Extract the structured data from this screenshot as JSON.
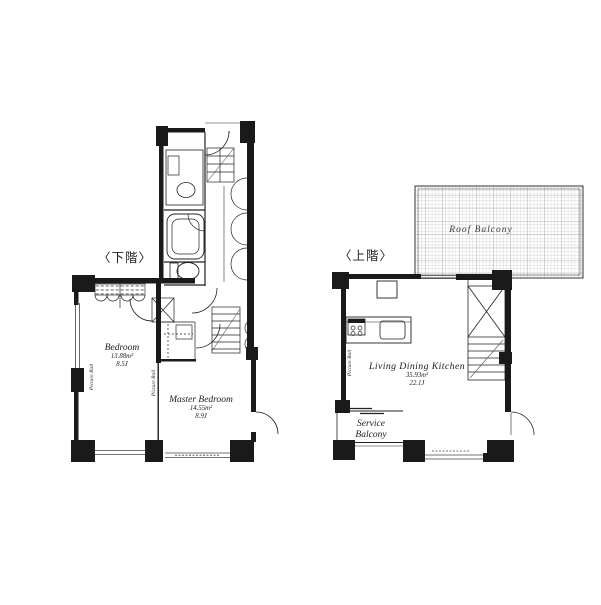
{
  "colors": {
    "ink": "#1a1a1a",
    "paper": "#ffffff",
    "grid_minor": "#b5b5b5",
    "grid_major": "#8f8f8f"
  },
  "floors": {
    "lower": {
      "label": "〈下階〉",
      "bedroom": {
        "name": "Bedroom",
        "area_m2": "13.88m²",
        "area_tatami": "8.5J"
      },
      "master": {
        "name": "Master Bedroom",
        "area_m2": "14.55m²",
        "area_tatami": "8.9J"
      },
      "picture_rail_left": "Picture Rail",
      "picture_rail_mid": "Picture Rail"
    },
    "upper": {
      "label": "〈上階〉",
      "ldk": {
        "name": "Living Dining Kitchen",
        "area_m2": "35.93m²",
        "area_tatami": "22.1J"
      },
      "roof_balcony_label": "Roof Balcony",
      "service_balcony": {
        "line1": "Service",
        "line2": "Balcony"
      },
      "picture_rail": "Picture Rail"
    }
  }
}
